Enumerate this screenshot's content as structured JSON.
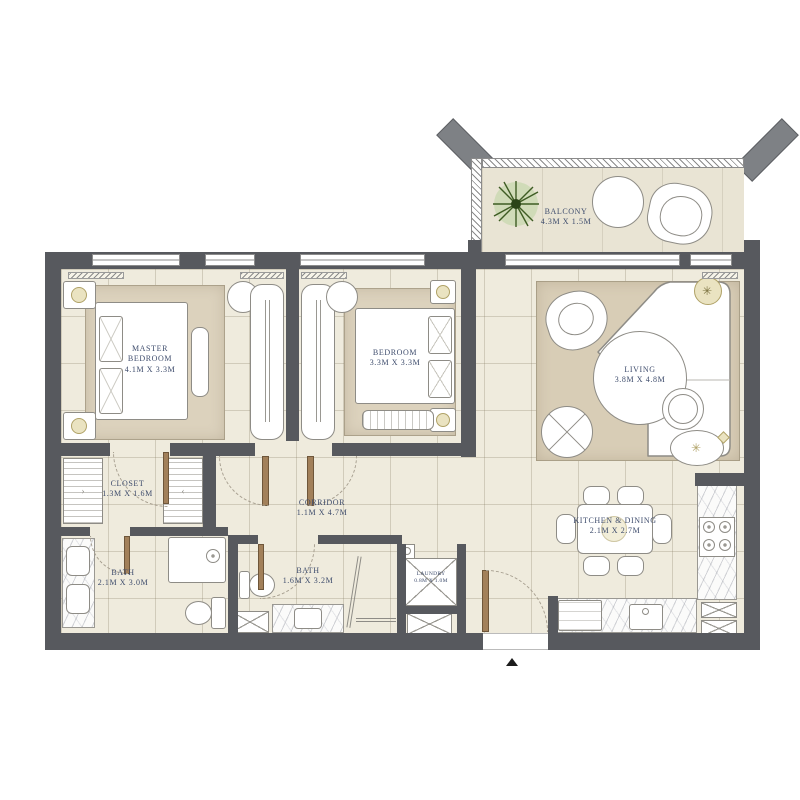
{
  "title": "two-bedroom apartment floor plan",
  "rooms": {
    "balcony": {
      "name": "BALCONY",
      "dims": "4.3M X 1.5M"
    },
    "master_bedroom": {
      "name": "MASTER BEDROOM",
      "dims": "4.1M X 3.3M"
    },
    "bedroom": {
      "name": "BEDROOM",
      "dims": "3.3M X 3.3M"
    },
    "living": {
      "name": "LIVING",
      "dims": "3.8M X 4.8M"
    },
    "closet": {
      "name": "CLOSET",
      "dims": "1.3M X 1.6M"
    },
    "corridor": {
      "name": "CORRIDOR",
      "dims": "1.1M X 4.7M"
    },
    "master_bath": {
      "name": "BATH",
      "dims": "2.1M X 3.0M"
    },
    "bath": {
      "name": "BATH",
      "dims": "1.6M X 3.2M"
    },
    "laundry": {
      "name": "LAUNDRY",
      "dims": "0.8M X 1.0M"
    },
    "kitchen_dining": {
      "name": "KITCHEN & DINING",
      "dims": "2.1M X 2.7M"
    }
  },
  "colors": {
    "wall": "#57595e",
    "floor": "#efebdd",
    "balcony_floor": "#e9e4d4",
    "rug": "#dcd2bd",
    "living_rug": "#d8cdb6",
    "label": "#3f4d6d",
    "gold": "#eae3c1",
    "gold_border": "#b0a267",
    "wood": "#a2805a",
    "outline": "#8e8c86",
    "arc": "#a8a091",
    "plant": "#3e5c23"
  }
}
